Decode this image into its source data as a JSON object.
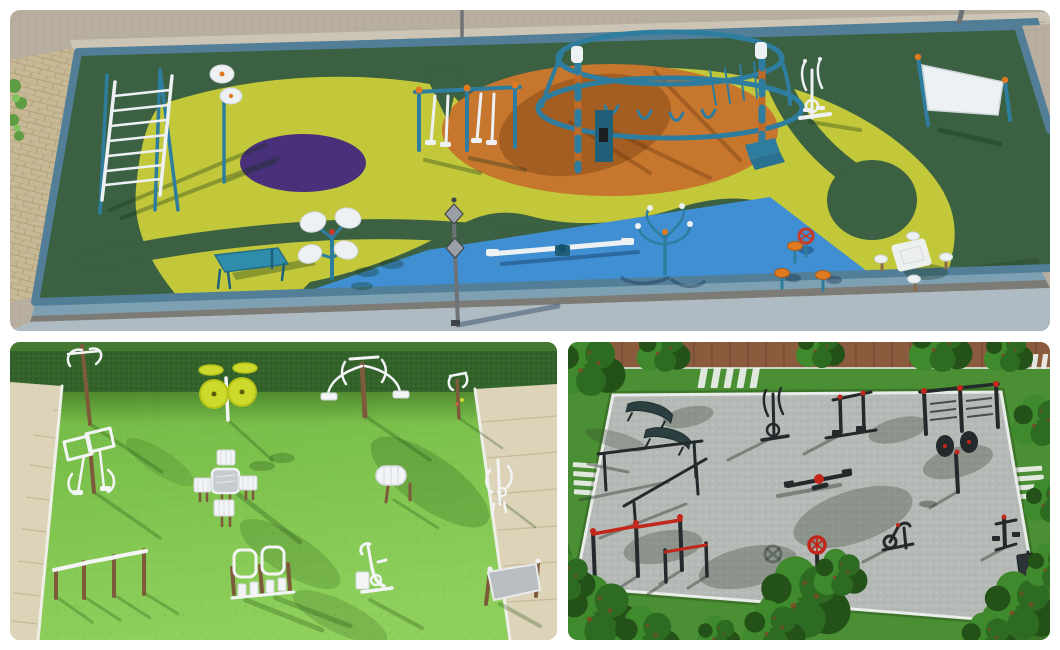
{
  "page": {
    "background": "#ffffff",
    "layout": "three-render-collage"
  },
  "palette": {
    "p1_concrete": "#b7aea0",
    "p1_concrete_dot": "#a59b8b",
    "p1_wall": "#ccc5b6",
    "p1_wall_line": "#b2a898",
    "p1_wall_cap": "#4f7e96",
    "p1_ledge": "#55564c",
    "p1_brick": "#c8b996",
    "p1_brick_line": "#b1a07c",
    "p1_field": "#3b6042",
    "p1_field_dark": "#33553a",
    "p1_yellow": "#c2c83a",
    "p1_orange": "#c6762d",
    "p1_purple": "#49307a",
    "p1_blue": "#3f8fd2",
    "p1_curb": "#527f97",
    "p1_curb_bottom": "#7da0b2",
    "p1_floor": "#aebbc2",
    "p1_teal_eq": "#2e7d9e",
    "p1_teal_dark": "#1f5f78",
    "p1_orange_eq": "#e07a20",
    "p1_white_eq": "#eef1f3",
    "p1_white_line": "#d0d6da",
    "p1_gray_pole": "#6e7377",
    "p1_lantern": "#9aa0a6",
    "p1_red": "#c63a28",
    "p1_plant": "#5d9c42",
    "p1_shadow_green": "rgba(20,50,25,0.32)",
    "p1_shadow_orange": "rgba(95,45,8,0.33)",
    "p1_shadow_blue": "rgba(10,35,70,0.35)",
    "p2_grass_top": "#6db440",
    "p2_grass_bottom": "#8fd05c",
    "p2_grass_dot": "#64a93a",
    "p2_hedge": "#33632b",
    "p2_hedge_dot": "#27511f",
    "p2_hedge_top": "#477d31",
    "p2_path": "#dcd3b8",
    "p2_path_line": "#c6ba99",
    "p2_white": "#f2f4f6",
    "p2_white_stroke": "#d9dee1",
    "p2_gray": "#c6cbcf",
    "p2_gray_dark": "#b9bec2",
    "p2_wood": "#7d5a3a",
    "p2_disc": "#cdd92b",
    "p2_disc_stroke": "#b4c217",
    "p2_shade": "rgba(25,70,15,0.27)",
    "p3_grass": "#4a8f33",
    "p3_grass_dark": "#3a7429",
    "p3_gravel": "#b6bab6",
    "p3_gravel_dot1": "#a2a8a1",
    "p3_gravel_dot2": "#c8ccc7",
    "p3_white_line": "#e9ece9",
    "p3_path": "#8a5b3d",
    "p3_plank": "#6f4831",
    "p3_tree1": "#2e6b22",
    "p3_tree2": "#3f8a2c",
    "p3_tree3": "#235117",
    "p3_tree_red": "#8a4524",
    "p3_trunk": "#6b4226",
    "p3_black": "#24292c",
    "p3_bench": "#2b3f40",
    "p3_red": "#c1271b",
    "p3_shadow": "rgba(50,62,52,0.45)",
    "p3_treeshadow": "rgba(62,76,62,0.35)"
  },
  "panels": {
    "top": {
      "name": "colorful EPDM rubber fitness playground render",
      "surface_zones": [
        "field-green",
        "yellow-zone",
        "purple-circle",
        "orange-ellipse",
        "blue-zone",
        "teal-curb",
        "concrete-surround",
        "brick-path",
        "boundary-wall"
      ],
      "equipment": [
        "monkey-bar-ladder",
        "spinning-discs-post",
        "air-walker-double",
        "climbing-dome",
        "sit-up-bench",
        "tai-chi-disc-station",
        "lamp-post",
        "seesaw",
        "arm-spinner",
        "elliptical-trainer",
        "sign-board",
        "stool-set-with-wheel",
        "picnic-table-set"
      ]
    },
    "bottom_left": {
      "name": "white outdoor gym equipment on lawn render",
      "surface_zones": [
        "lawn",
        "hedge",
        "paved-path-left",
        "paved-path-right"
      ],
      "equipment": [
        "hanging-hook-post",
        "tai-chi-wheels",
        "dual-pull-down",
        "handle-post",
        "pendulum-swing",
        "chess-table-set",
        "back-roller",
        "small-climber",
        "stepped-push-up-bars",
        "double-leg-press",
        "exercise-bike",
        "sign-board"
      ]
    },
    "bottom_right": {
      "name": "street workout park on gravel render",
      "surface_zones": [
        "gravel-platform",
        "grass-surround",
        "wood-plank-path",
        "crosswalk-stripes",
        "pine-trees"
      ],
      "equipment": [
        "curved-benches",
        "parallel-bars",
        "elliptical-trainer",
        "press-machine",
        "wall-bars",
        "seesaw",
        "tai-chi-wheels",
        "pull-up-bars",
        "steering-wheel-spinner",
        "exercise-ball",
        "exercise-bike",
        "hydraulic-machine",
        "sign-board"
      ]
    }
  }
}
